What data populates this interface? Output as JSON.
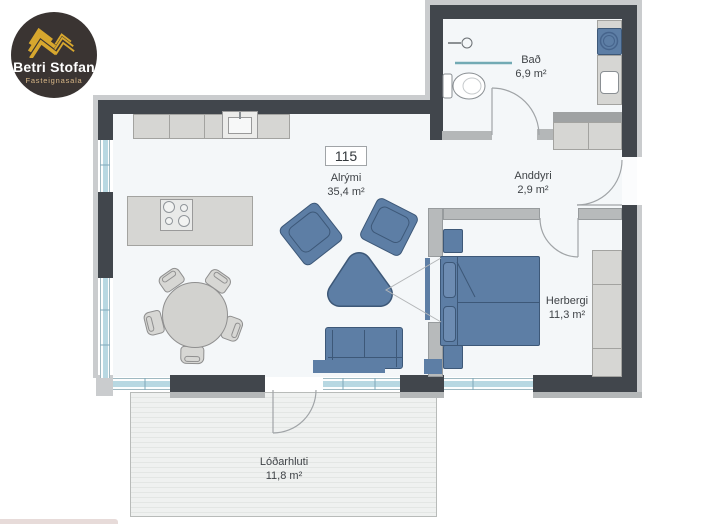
{
  "logo": {
    "brand": "Betri Stofan",
    "tagline": "Fasteignasala"
  },
  "unit": {
    "number": "115"
  },
  "rooms": {
    "alrymi": {
      "name": "Alrými",
      "area": "35,4 m²"
    },
    "bad": {
      "name": "Bað",
      "area": "6,9 m²"
    },
    "anddyri": {
      "name": "Anddyri",
      "area": "2,9 m²"
    },
    "herbergi": {
      "name": "Herbergi",
      "area": "11,3 m²"
    },
    "lodarhluti": {
      "name": "Lóðarhluti",
      "area": "11,8 m²"
    }
  },
  "colors": {
    "wall": "#41464c",
    "partition": "#b7babb",
    "furniture_blue": "#5d7ea5",
    "furniture_gray": "#d6d6d3",
    "window_glass": "#b8d8e2",
    "floor": "#f4f7f9",
    "shower_screen": "#72aab4",
    "logo_bg": "#3a3432",
    "logo_gold": "#d7a72e"
  },
  "fixtures": [
    "kitchen-counter",
    "kitchen-sink",
    "cooktop",
    "kitchen-island",
    "dining-table",
    "dining-chairs",
    "armchairs",
    "coffee-table",
    "sofa",
    "tv-bench",
    "tv",
    "bed",
    "pillows",
    "nightstands",
    "wardrobe",
    "entry-closet",
    "washing-machine",
    "bathroom-counter",
    "bathroom-sink",
    "toilet",
    "shower-head",
    "shower-screen"
  ]
}
